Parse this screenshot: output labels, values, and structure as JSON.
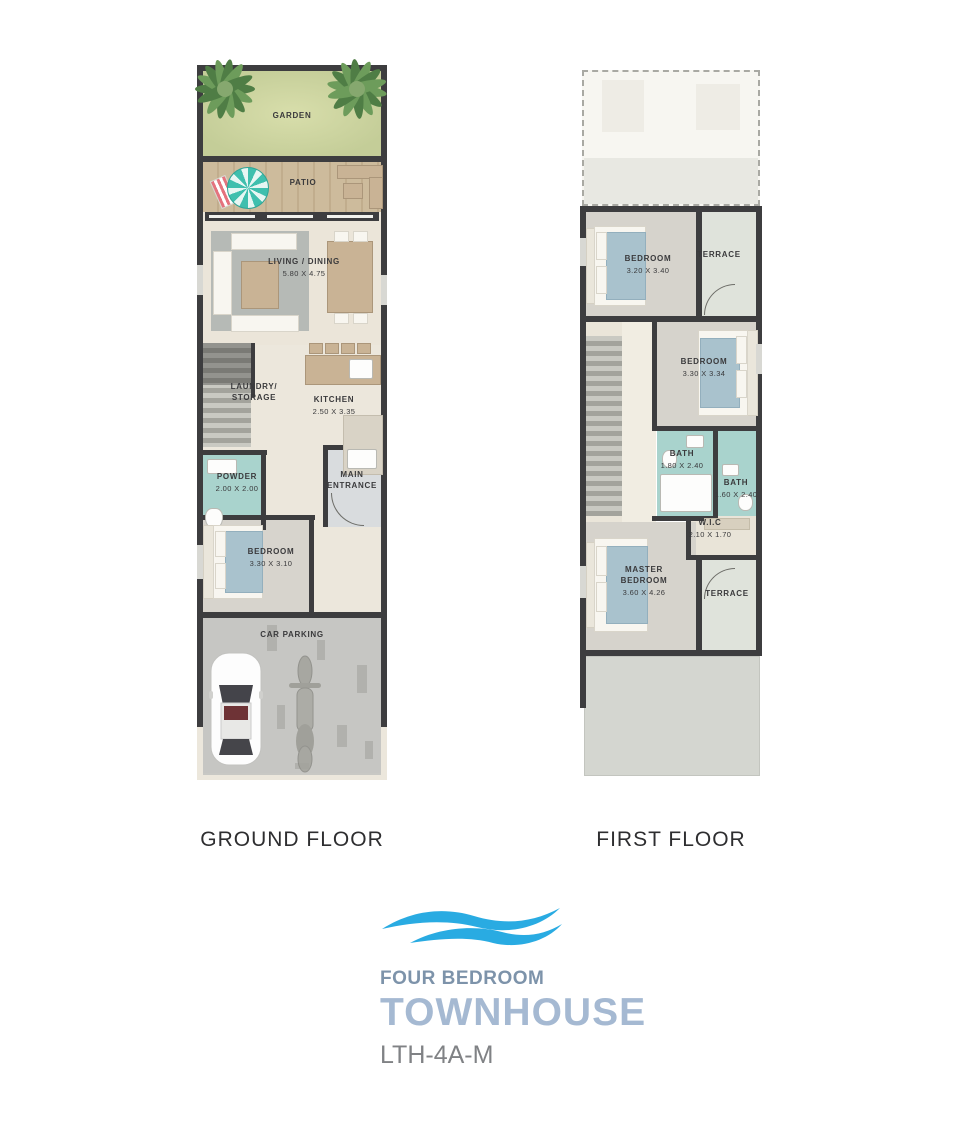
{
  "document": {
    "ground_title": "GROUND FLOOR",
    "first_title": "FIRST FLOOR"
  },
  "ground_rooms": {
    "garden": {
      "label": "GARDEN"
    },
    "patio": {
      "label": "PATIO"
    },
    "living": {
      "label": "LIVING / DINING",
      "dims": "5.80 X 4.75"
    },
    "laundry": {
      "label": "LAUNDRY/\nSTORAGE"
    },
    "kitchen": {
      "label": "KITCHEN",
      "dims": "2.50 X 3.35"
    },
    "powder": {
      "label": "POWDER",
      "dims": "2.00 X 2.00"
    },
    "entrance": {
      "label": "MAIN\nENTRANCE"
    },
    "bedroom": {
      "label": "BEDROOM",
      "dims": "3.30 X 3.10"
    },
    "parking": {
      "label": "CAR PARKING"
    }
  },
  "first_rooms": {
    "bedroom1": {
      "label": "BEDROOM",
      "dims": "3.20 X 3.40"
    },
    "terrace1": {
      "label": "TERRACE"
    },
    "bedroom2": {
      "label": "BEDROOM",
      "dims": "3.30 X 3.34"
    },
    "bath1": {
      "label": "BATH",
      "dims": "1.80 X 2.40"
    },
    "bath2": {
      "label": "BATH",
      "dims": "1.60 X 2.40"
    },
    "wic": {
      "label": "W.I.C",
      "dims": "2.10 X 1.70"
    },
    "master": {
      "label": "MASTER\nBEDROOM",
      "dims": "3.60 X 4.26"
    },
    "terrace2": {
      "label": "TERRACE"
    }
  },
  "branding": {
    "category": "FOUR BEDROOM",
    "name": "TOWNHOUSE",
    "code": "LTH-4A-M"
  },
  "colors": {
    "wave_blue": "#29abe2",
    "category_text": "#7d93aa",
    "name_text": "#a5b9d2",
    "code_text": "#808285",
    "wall": "#3d3d3f",
    "garden_green": "#c9d1a0",
    "patio_wood": "#cdbb9c",
    "bath_teal": "#a9d3cd",
    "floor_beige": "#ece7dc"
  }
}
